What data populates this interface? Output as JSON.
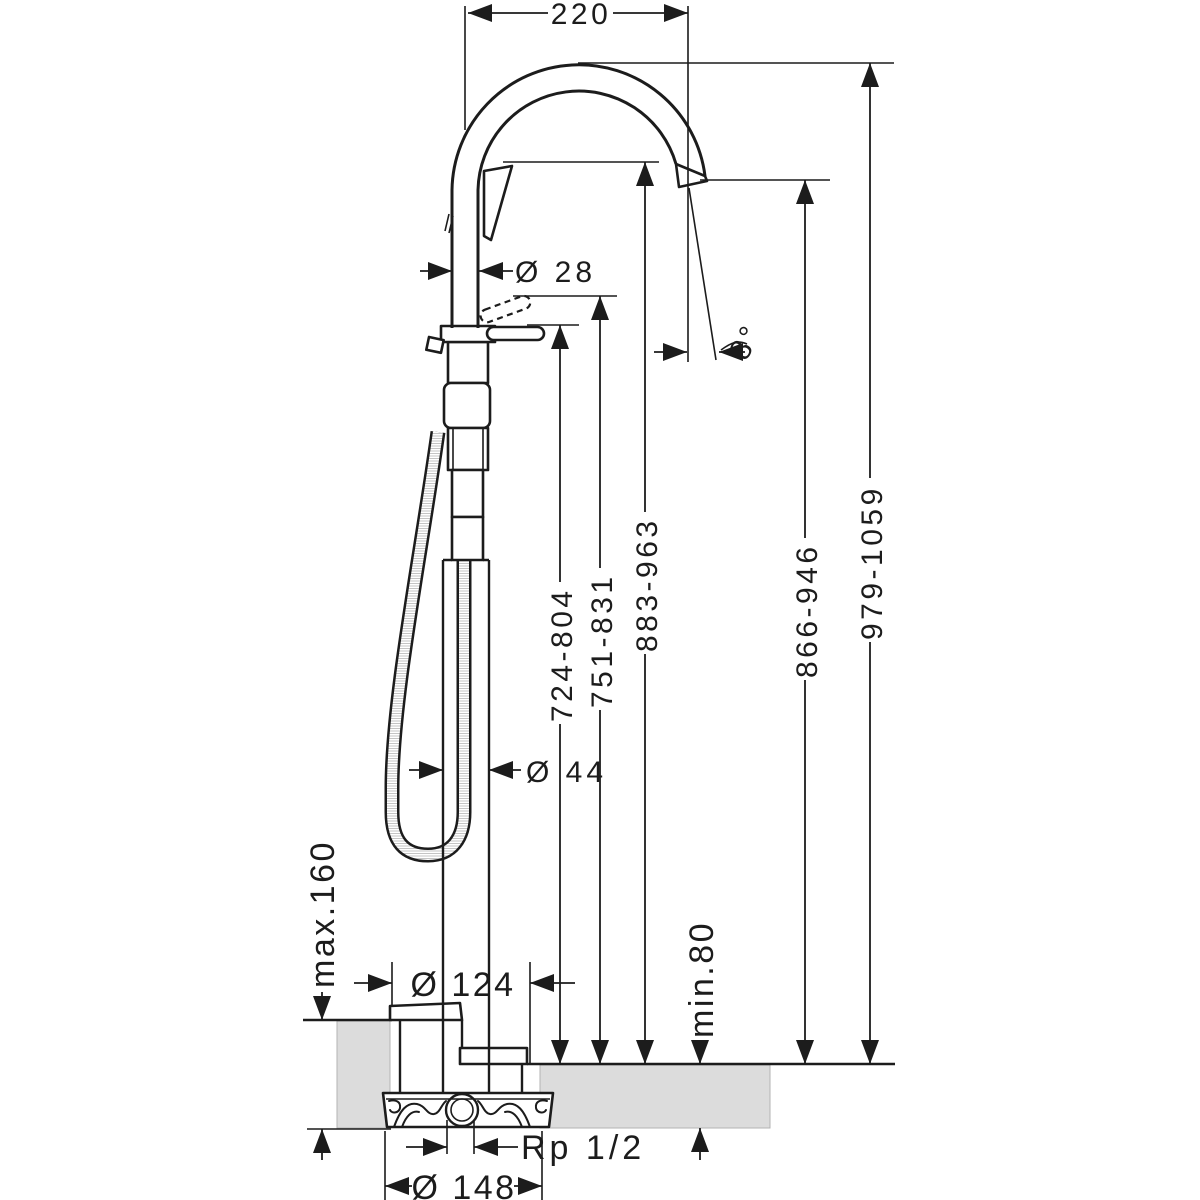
{
  "drawing": {
    "kind": "technical-dimension-drawing",
    "subject": "freestanding single lever bath mixer with hand shower and floor rough-in set",
    "colors": {
      "line": "#1c1c1c",
      "floor_fill": "#dcdcdc",
      "background": "#ffffff"
    }
  },
  "labels": {
    "spout_reach": "220",
    "spout_pipe_diameter": "Ø 28",
    "spout_angle": "8°",
    "lever_height_range": "724-804",
    "lever_raised_height_range": "751-831",
    "handshower_height_range": "883-963",
    "spout_outlet_height_range": "866-946",
    "overall_height_range": "979-1059",
    "riser_diameter": "Ø 44",
    "floor_buildup_max": "max.160",
    "base_plate_diameter": "Ø 124",
    "screed_min": "min.80",
    "connection_thread": "Rp 1/2",
    "rough_in_diameter": "Ø 148"
  }
}
